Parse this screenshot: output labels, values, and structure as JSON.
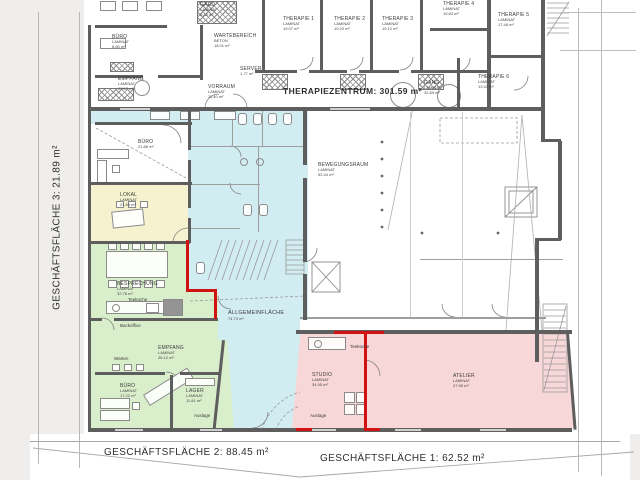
{
  "titles": {
    "therapiezentrum": "THERAPIEZENTRUM:  301.59 m²",
    "gf1": "GESCHÄFTSFLÄCHE 1:  62.52 m²",
    "gf2": "GESCHÄFTSFLÄCHE 2:  88.45 m²",
    "gf3": "GESCHÄFTSFLÄCHE 3:  21.89 m²"
  },
  "rooms": {
    "buero_top": {
      "name": "BÜRO",
      "material": "LAMINAT",
      "area": "8.80 m²"
    },
    "empfang_top": {
      "name": "EMPFANG",
      "material": "LAMINAT",
      "area": "23.67 m²"
    },
    "wartebereich": {
      "name": "WARTEBEREICH",
      "material": "BETON",
      "area": "16.01 m²"
    },
    "gard": {
      "name": "GARD",
      "material": "LAMINAT",
      "area": "5.88 m²"
    },
    "server": {
      "name": "SERVER",
      "material": "",
      "area": "1.77 m²"
    },
    "vorraum": {
      "name": "VORRAUM",
      "material": "LAMINAT",
      "area": "11.40 m²"
    },
    "therapie1": {
      "name": "THERAPIE 1",
      "material": "LAMINAT",
      "area": "19.07 m²"
    },
    "therapie2": {
      "name": "THERAPIE 2",
      "material": "LAMINAT",
      "area": "19.20 m²"
    },
    "therapie3": {
      "name": "THERAPIE 3",
      "material": "LAMINAT",
      "area": "19.12 m²"
    },
    "therapie4": {
      "name": "THERAPIE 4",
      "material": "LAMINAT",
      "area": "19.63 m²"
    },
    "therapie5": {
      "name": "THERAPIE 5",
      "material": "LAMINAT",
      "area": "17.48 m²"
    },
    "therapie6": {
      "name": "THERAPIE 6",
      "material": "LAMINAT",
      "area": "13.43 m²"
    },
    "gang": {
      "name": "GANG",
      "material": "LAMINAT",
      "area": "32.89 m²"
    },
    "bewegungsraum": {
      "name": "BEWEGUNGSRAUM",
      "material": "LAMINAT",
      "area": "52.44 m²"
    },
    "buero_mitte": {
      "name": "BÜRO",
      "material": "",
      "area": "21.86 m²"
    },
    "lokal": {
      "name": "LOKAL",
      "material": "LAMINAT",
      "area": "21.89 m²"
    },
    "allgemeinflaeche": {
      "name": "ALLGEMEINFLÄCHE",
      "material": "",
      "area": "74.73 m²"
    },
    "besprechung": {
      "name": "BESPRECHUNG",
      "material": "LAMINAT",
      "area": "32.78 m²"
    },
    "empfang_gf2": {
      "name": "EMPFANG",
      "material": "LAMINAT",
      "area": "26.12 m²"
    },
    "buero_gf2": {
      "name": "BÜRO",
      "material": "LAMINAT",
      "area": "17.22 m²"
    },
    "lager": {
      "name": "LAGER",
      "material": "LAMINAT",
      "area": "11.81 m²"
    },
    "studio": {
      "name": "STUDIO",
      "material": "LAMINAT",
      "area": "34.95 m²"
    },
    "atelier": {
      "name": "ATELIER",
      "material": "LAMINAT",
      "area": "27.95 m²"
    }
  },
  "small_labels": {
    "teekueche_gf2": "Teeküche",
    "backoffice": "Backoffice",
    "warten": "Warten",
    "auslage_gf2": "Auslage",
    "teekueche_gf1": "Teeküche",
    "auslage_gf1": "Auslage"
  },
  "colors": {
    "common_area_cyan": "#d2edf2",
    "gf3_yellow": "#f6f2cf",
    "gf2_green": "#d9eecb",
    "gf1_pink": "#f8d7d8",
    "red_wall": "#d01311",
    "wall_gray": "#5e5e5e",
    "paper": "#ffffff"
  }
}
